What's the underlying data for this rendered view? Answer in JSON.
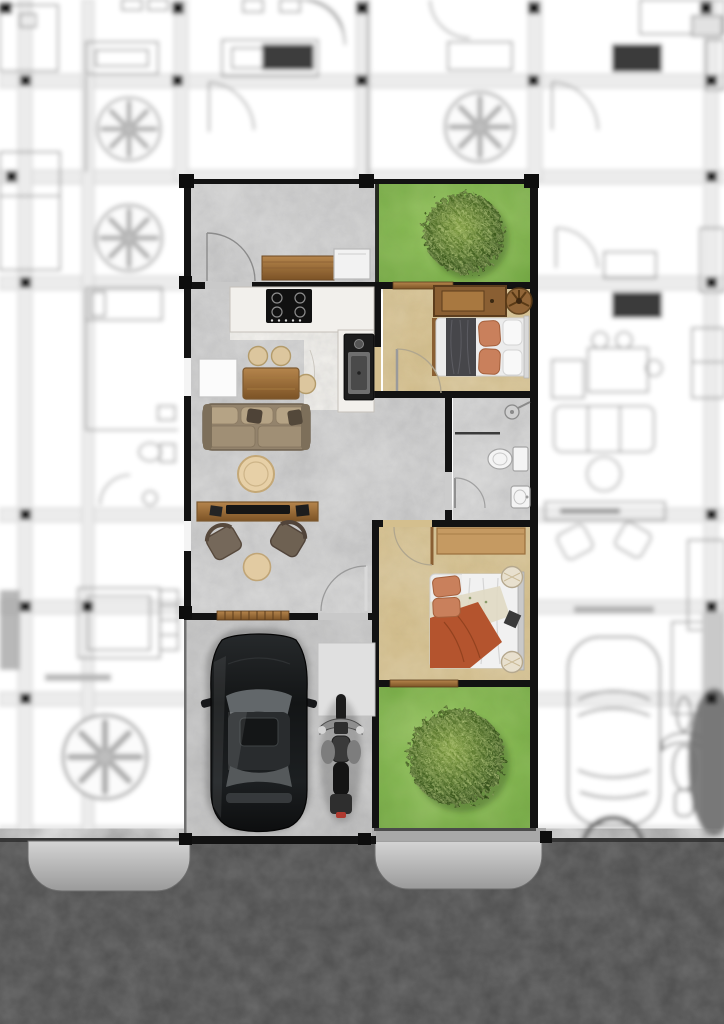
{
  "scene": {
    "kind": "rendered-floor-plan",
    "description": "Colored top-view render of one row-house unit surrounded by blurred blueprint neighbors and an asphalt street at the bottom"
  },
  "colors": {
    "wall": "#121212",
    "line": "#8f8f8f",
    "concrete": "#c9c9c9",
    "concrete_dark": "#bcbcbc",
    "bath_floor": "#cccccc",
    "marble": "#f0eee9",
    "tan_floor": "#d4bf8e",
    "grass_light": "#95c75f",
    "grass_dark": "#67a039",
    "tree_light": "#7d9a40",
    "tree_dark": "#2c4416",
    "wood": "#b5854c",
    "wood_dark": "#7c5326",
    "sofa": "#93836c",
    "terracotta": "#b4542e",
    "terracotta_light": "#c9805c",
    "blanket_gray": "#46464a",
    "white_item": "#f6f6f6",
    "car_body": "#1a1c1e",
    "glass": "#62676a",
    "road": "#4e4e4e",
    "apron_light": "#d4d4d4",
    "apron_dark": "#9a9a9a",
    "pad": "#e0e0e0",
    "sidewalk": "#a8a8a8"
  },
  "unit": {
    "rooms": [
      {
        "id": "terrace",
        "name": "entry terrace",
        "furniture": [
          "wood-bench",
          "storage-cabinet",
          "entry-door"
        ]
      },
      {
        "id": "front-garden",
        "name": "front garden",
        "furniture": [
          "tree"
        ]
      },
      {
        "id": "kitchen",
        "name": "kitchen",
        "furniture": [
          "l-shaped-counter",
          "gas-cooktop",
          "sink"
        ]
      },
      {
        "id": "bedroom-1",
        "name": "bedroom 1",
        "furniture": [
          "wardrobe",
          "ceiling-fan",
          "double-bed",
          "door"
        ]
      },
      {
        "id": "hallway",
        "name": "hallway",
        "furniture": []
      },
      {
        "id": "bathroom",
        "name": "bathroom",
        "furniture": [
          "shower",
          "toilet",
          "washbasin",
          "door"
        ]
      },
      {
        "id": "living-room",
        "name": "living and dining room",
        "furniture": [
          "white-cabinet",
          "dining-table",
          "stool",
          "stool",
          "stool",
          "sofa",
          "coffee-table",
          "tv-console",
          "tv",
          "armchair",
          "armchair",
          "side-table",
          "back-door",
          "slatted-window"
        ]
      },
      {
        "id": "bedroom-2",
        "name": "bedroom 2",
        "furniture": [
          "wall-shelf",
          "double-bed",
          "bedside-table",
          "bedside-table",
          "door"
        ]
      },
      {
        "id": "back-garden",
        "name": "back garden",
        "furniture": [
          "tree"
        ]
      },
      {
        "id": "carport",
        "name": "carport",
        "furniture": [
          "car",
          "motorcycle",
          "storage-pad"
        ]
      }
    ]
  },
  "surroundings": {
    "left_neighbor": "blurred blueprint unit",
    "right_neighbor": "blurred blueprint unit",
    "top_neighbor": "blurred blueprint unit",
    "blueprint_trees": 4,
    "road": "asphalt street",
    "driveway_aprons": 2
  }
}
